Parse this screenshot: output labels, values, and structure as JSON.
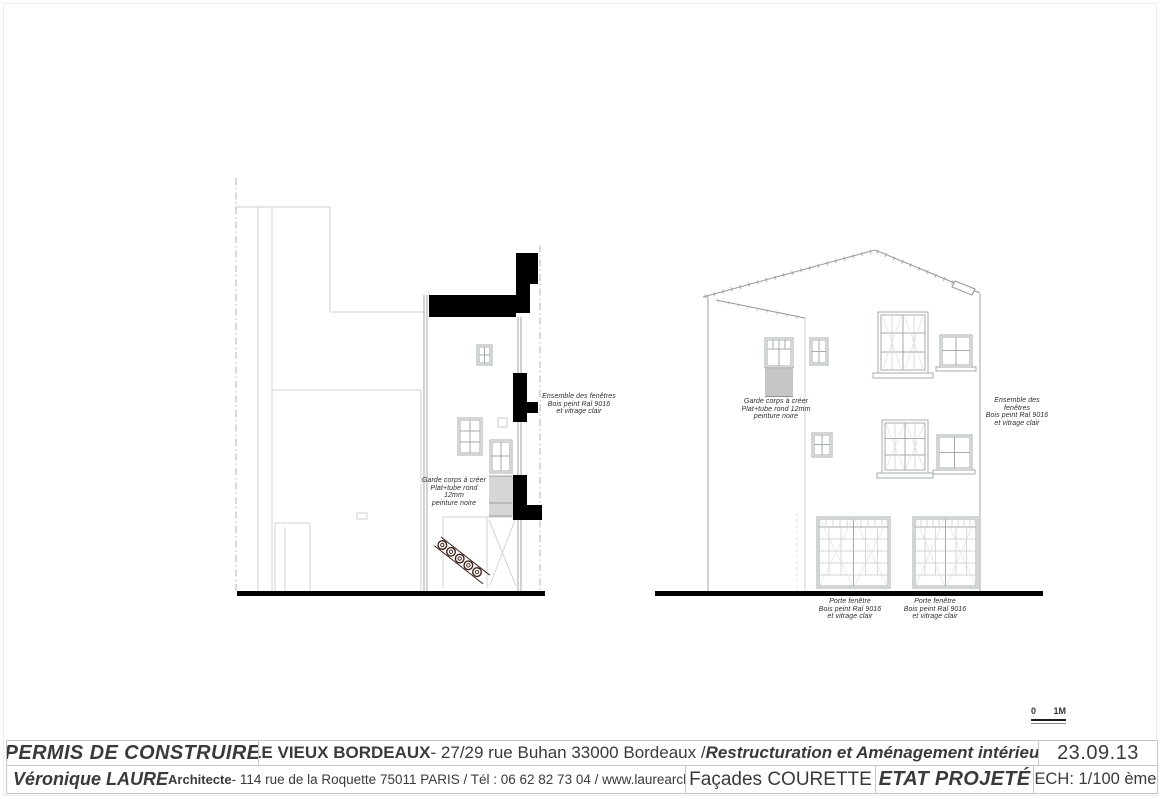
{
  "title_block": {
    "permit_label": "PERMIS DE CONSTRUIRE",
    "project_name": "LE VIEUX BORDEAUX",
    "project_address": " - 27/29 rue Buhan 33000 Bordeaux / ",
    "project_subtitle": "Restructuration et Aménagement intérieur",
    "date": "23.09.13",
    "architect_name": "Véronique LAURE",
    "architect_title": " Architecte",
    "architect_details": " - 114 rue de la Roquette 75011 PARIS / Tél : 06 62 82 73 04 / www.laurearchitecture.com",
    "drawing_title": "Façades COURETTE",
    "status": "ETAT PROJETÉ",
    "scale": "ECH: 1/100 ème"
  },
  "annotations": [
    {
      "id": "left-ensemble-fenetres",
      "lines": [
        "Ensemble des fenêtres",
        "Bois peint Ral 9016",
        "et vitrage clair"
      ]
    },
    {
      "id": "left-garde-corps",
      "lines": [
        "Garde corps à créer",
        "Plat+tube rond 12mm",
        "peinture noire"
      ]
    },
    {
      "id": "right-garde-corps",
      "lines": [
        "Garde corps à créer",
        "Plat+tube rond 12mm",
        "peinture noire"
      ]
    },
    {
      "id": "right-ensemble-fenetres",
      "lines": [
        "Ensemble des fenêtres",
        "Bois peint Ral 9016",
        "et vitrage clair"
      ]
    },
    {
      "id": "porte-fenetre-left",
      "lines": [
        "Porte fenêtre",
        "Bois peint Ral 9016",
        "et vitrage clair"
      ]
    },
    {
      "id": "porte-fenetre-right",
      "lines": [
        "Porte fenêtre",
        "Bois peint Ral 9016",
        "et vitrage clair"
      ]
    }
  ],
  "scale_bar": {
    "start_label": "0",
    "end_label": "1M"
  },
  "colors": {
    "section_fill": "#000000",
    "background_lines": "#d2d2d2",
    "window_frame": "#a3abab",
    "ironwork": "#3e2219",
    "text_dark": "#3a3a3e"
  }
}
